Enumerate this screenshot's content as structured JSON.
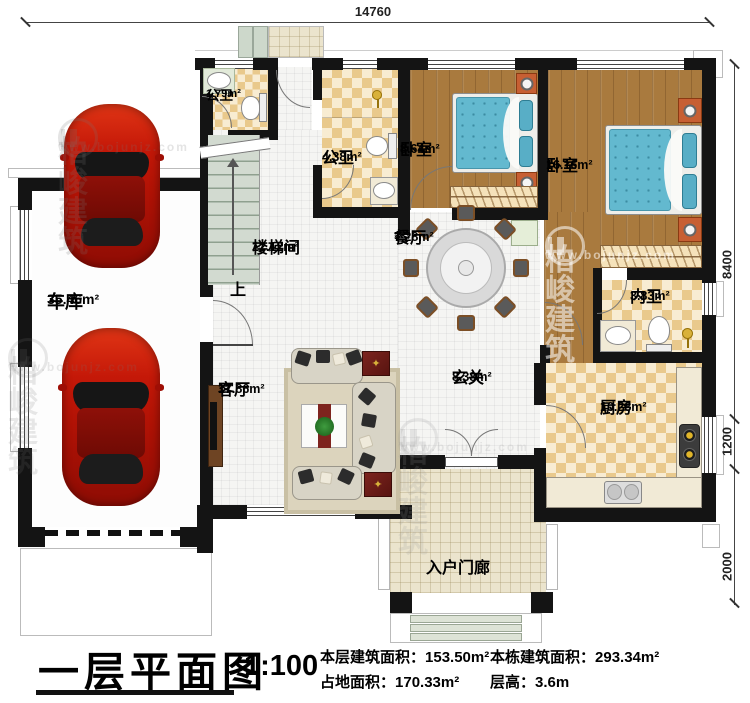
{
  "plan": {
    "title": "一层平面图",
    "scale": "1:100",
    "stats": {
      "floor_area_label": "本层建筑面积：",
      "floor_area_value": "153.50m²",
      "footprint_label": "占地面积：",
      "footprint_value": "170.33m²",
      "building_area_label": "本栋建筑面积：",
      "building_area_value": "293.34m²",
      "story_height_label": "层高：",
      "story_height_value": "3.6m"
    }
  },
  "dimensions": {
    "top_width": "14760",
    "right_upper": "8400",
    "right_middle": "1200",
    "right_lower": "2000"
  },
  "rooms": {
    "garage": {
      "name": "车库",
      "area": "35.46m²"
    },
    "bath_small": {
      "name": "公卫",
      "area": "1.79m²"
    },
    "bath_public": {
      "name": "公卫",
      "area": "4.38m²"
    },
    "bedroom_small": {
      "name": "卧室",
      "area": "8.64m²"
    },
    "bedroom_large": {
      "name": "卧室",
      "area": "16.16m²"
    },
    "stairwell": {
      "name": "楼梯间",
      "area": "12.12m²"
    },
    "dining": {
      "name": "餐厅",
      "area": "7.28m²"
    },
    "bath_inner": {
      "name": "内卫",
      "area": "3.83m²"
    },
    "living": {
      "name": "客厅",
      "area": "17.86m²"
    },
    "foyer": {
      "name": "玄关",
      "area": "8.38m²"
    },
    "kitchen": {
      "name": "厨房",
      "area": "10.28m²"
    },
    "porch": {
      "name": "入户门廊"
    }
  },
  "annotations": {
    "stair_up": "上"
  },
  "icons": {
    "star": "✦"
  },
  "watermark": {
    "brand": "柏峻建筑",
    "url": "www.bojunjz.com"
  },
  "colors": {
    "wall": "#141414",
    "wood_floor": "#a97a3e",
    "tile_checker": "#e9c98c",
    "mattress_blue": "#63b9cf",
    "car_red": "#c41808",
    "porch_tile": "#ebe4cd"
  }
}
